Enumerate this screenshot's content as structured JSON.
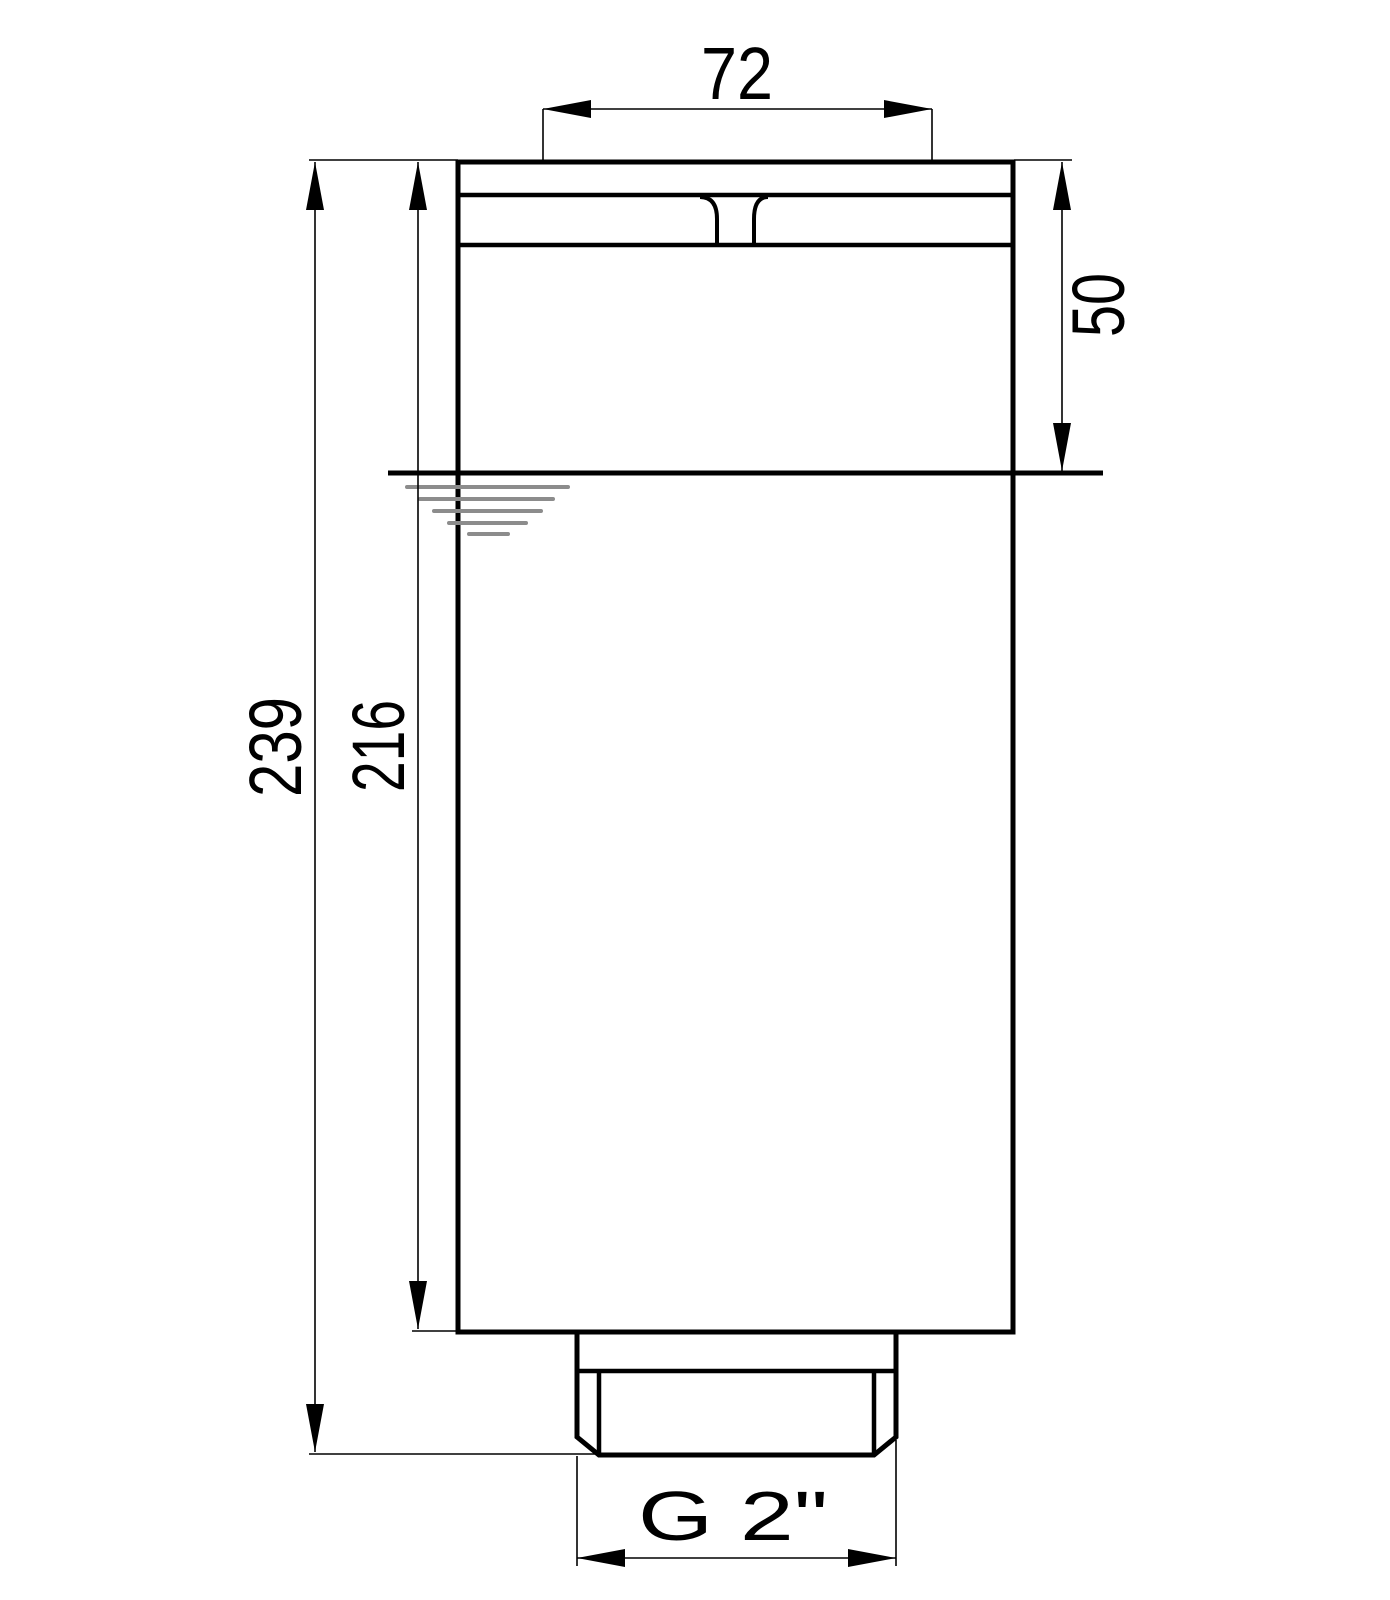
{
  "drawing": {
    "type": "dimensioned technical drawing, front view of a threaded immersion unit",
    "dimensions": {
      "top_width": "72",
      "immersion_depth": "50",
      "overall_height": "239",
      "body_height": "216",
      "thread": "G 2\""
    },
    "symbols": {
      "water_level": "water-level symbol (level line with tapering ripple bars)"
    },
    "colors": {
      "line": "#000000",
      "water_symbol": "#8c8c8c",
      "background": "#ffffff"
    }
  }
}
